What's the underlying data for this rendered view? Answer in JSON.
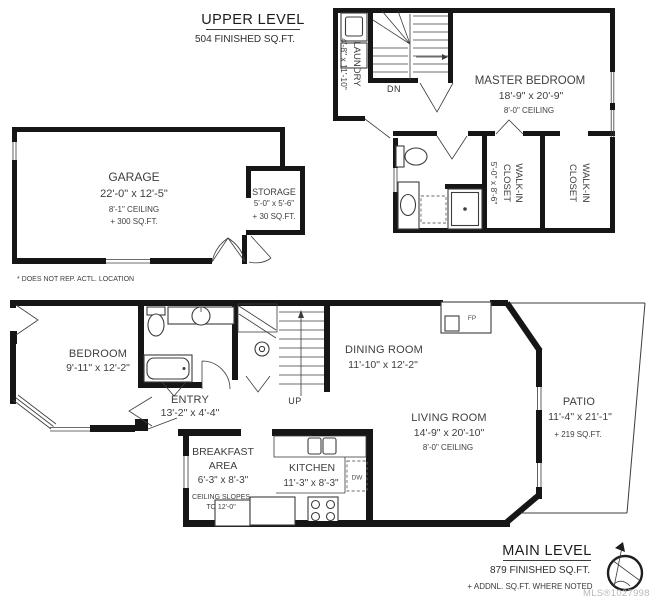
{
  "colors": {
    "wall": "#161616",
    "thin_line": "#3c3c3c",
    "text": "#3e3e3e",
    "watermark": "#b9b9b9",
    "background": "#ffffff"
  },
  "upper_level": {
    "title": "UPPER LEVEL",
    "subtitle": "504 FINISHED SQ.FT.",
    "footnote": "* DOES NOT REP. ACTL. LOCATION",
    "stair_label": "DN",
    "laundry": {
      "name": "LAUNDRY",
      "dims": "4'-8\" x 11'-10\""
    },
    "master_bedroom": {
      "name": "MASTER BEDROOM",
      "dims": "18'-9\" x 20'-9\"",
      "ceiling": "8'-0\" CEILING"
    },
    "walk_in_closet_1": {
      "name_line1": "WALK-IN",
      "name_line2": "CLOSET",
      "dims": "5'-0\" x 8'-6\""
    },
    "walk_in_closet_2": {
      "name_line1": "WALK-IN",
      "name_line2": "CLOSET"
    },
    "garage": {
      "name": "GARAGE",
      "dims": "22'-0\" x 12'-5\"",
      "ceiling": "8'-1\" CEILING",
      "extra": "+ 300 SQ.FT."
    },
    "storage": {
      "name": "STORAGE",
      "dims": "5'-0\" x 5'-6\"",
      "extra": "+ 30 SQ.FT."
    }
  },
  "main_level": {
    "title": "MAIN LEVEL",
    "subtitle": "879 FINISHED SQ.FT.",
    "note": "+ ADDNL. SQ.FT. WHERE NOTED",
    "stair_label": "UP",
    "fireplace_label": "FP",
    "dishwasher_label": "DW",
    "watermark": "MLS®1027998",
    "bedroom": {
      "name": "BEDROOM",
      "dims": "9'-11\" x 12'-2\""
    },
    "entry": {
      "name": "ENTRY",
      "dims": "13'-2\" x 4'-4\""
    },
    "dining_room": {
      "name": "DINING ROOM",
      "dims": "11'-10\" x 12'-2\""
    },
    "living_room": {
      "name": "LIVING ROOM",
      "dims": "14'-9\" x 20'-10\"",
      "ceiling": "8'-0\" CEILING"
    },
    "patio": {
      "name": "PATIO",
      "dims": "11'-4\" x 21'-1\"",
      "extra": "+ 219 SQ.FT."
    },
    "breakfast_area": {
      "name_line1": "BREAKFAST",
      "name_line2": "AREA",
      "dims": "6'-3\" x 8'-3\"",
      "note_line1": "CEILING SLOPES",
      "note_line2": "TO 12'-0\""
    },
    "kitchen": {
      "name": "KITCHEN",
      "dims": "11'-3\" x 8'-3\""
    }
  }
}
